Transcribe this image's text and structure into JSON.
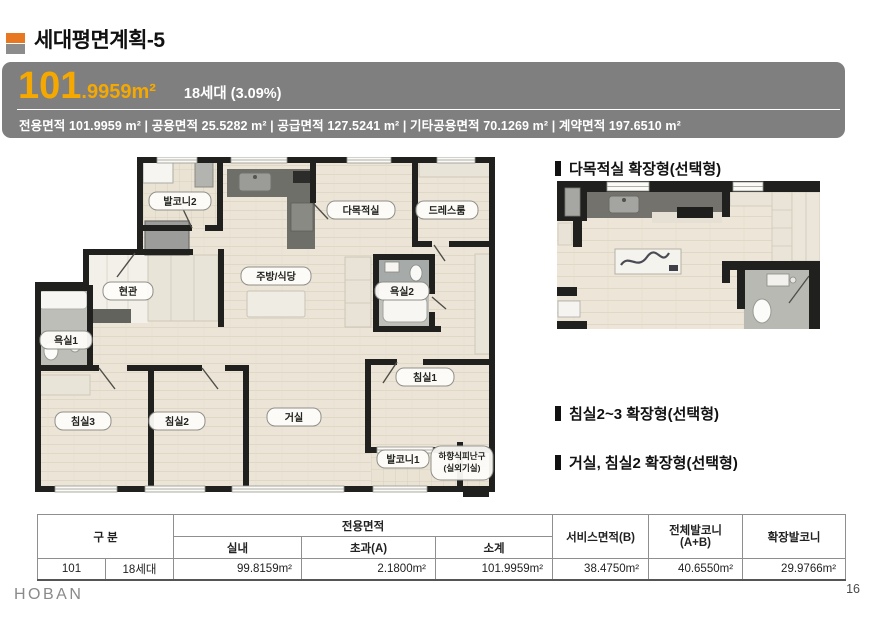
{
  "page": {
    "title": "세대평면계획-5",
    "page_number": "16",
    "brand": "HOBAN"
  },
  "unit_header": {
    "area_main": "101",
    "area_frac": ".9959m²",
    "household": "18세대 (3.09%)",
    "detail_line": "전용면적 101.9959 m²  |  공용면적 25.5282 m²  |  공급면적 127.5241 m²  |  기타공용면적 70.1269 m²  |  계약면적 197.6510 m²"
  },
  "options": {
    "opt1": "다목적실 확장형(선택형)",
    "opt2": "침실2~3 확장형(선택형)",
    "opt3": "거실, 침실2 확장형(선택형)"
  },
  "plan": {
    "rooms": {
      "balcony2": "발코니2",
      "multipurpose": "다목적실",
      "dressroom": "드레스룸",
      "kitchen": "주방/식당",
      "entrance": "현관",
      "bath2": "욕실2",
      "bath1": "욕실1",
      "bed1": "침실1",
      "bed3": "침실3",
      "bed2": "침실2",
      "living": "거실",
      "balcony1": "발코니1",
      "escape1": "하향식피난구",
      "escape2": "(실외기실)"
    }
  },
  "table": {
    "headers": {
      "gubun": "구 분",
      "jeonyong": "전용면적",
      "silnae": "실내",
      "chogwa": "초과(A)",
      "sogye": "소계",
      "service": "서비스면적(B)",
      "balcony_total_1": "전체발코니",
      "balcony_total_2": "(A+B)",
      "balcony_ext": "확장발코니"
    },
    "row": {
      "type": "101",
      "units": "18세대",
      "silnae": "99.8159m²",
      "chogwa": "2.1800m²",
      "sogye": "101.9959m²",
      "service": "38.4750m²",
      "balcony_total": "40.6550m²",
      "balcony_ext": "29.9766m²"
    }
  },
  "colors": {
    "accent_orange": "#F5A800",
    "header_gray": "#7F7F7F",
    "bullet_orange": "#E87722",
    "bullet_gray": "#8C8C8C",
    "wall": "#20201E",
    "floor": "#ECE5D7"
  }
}
